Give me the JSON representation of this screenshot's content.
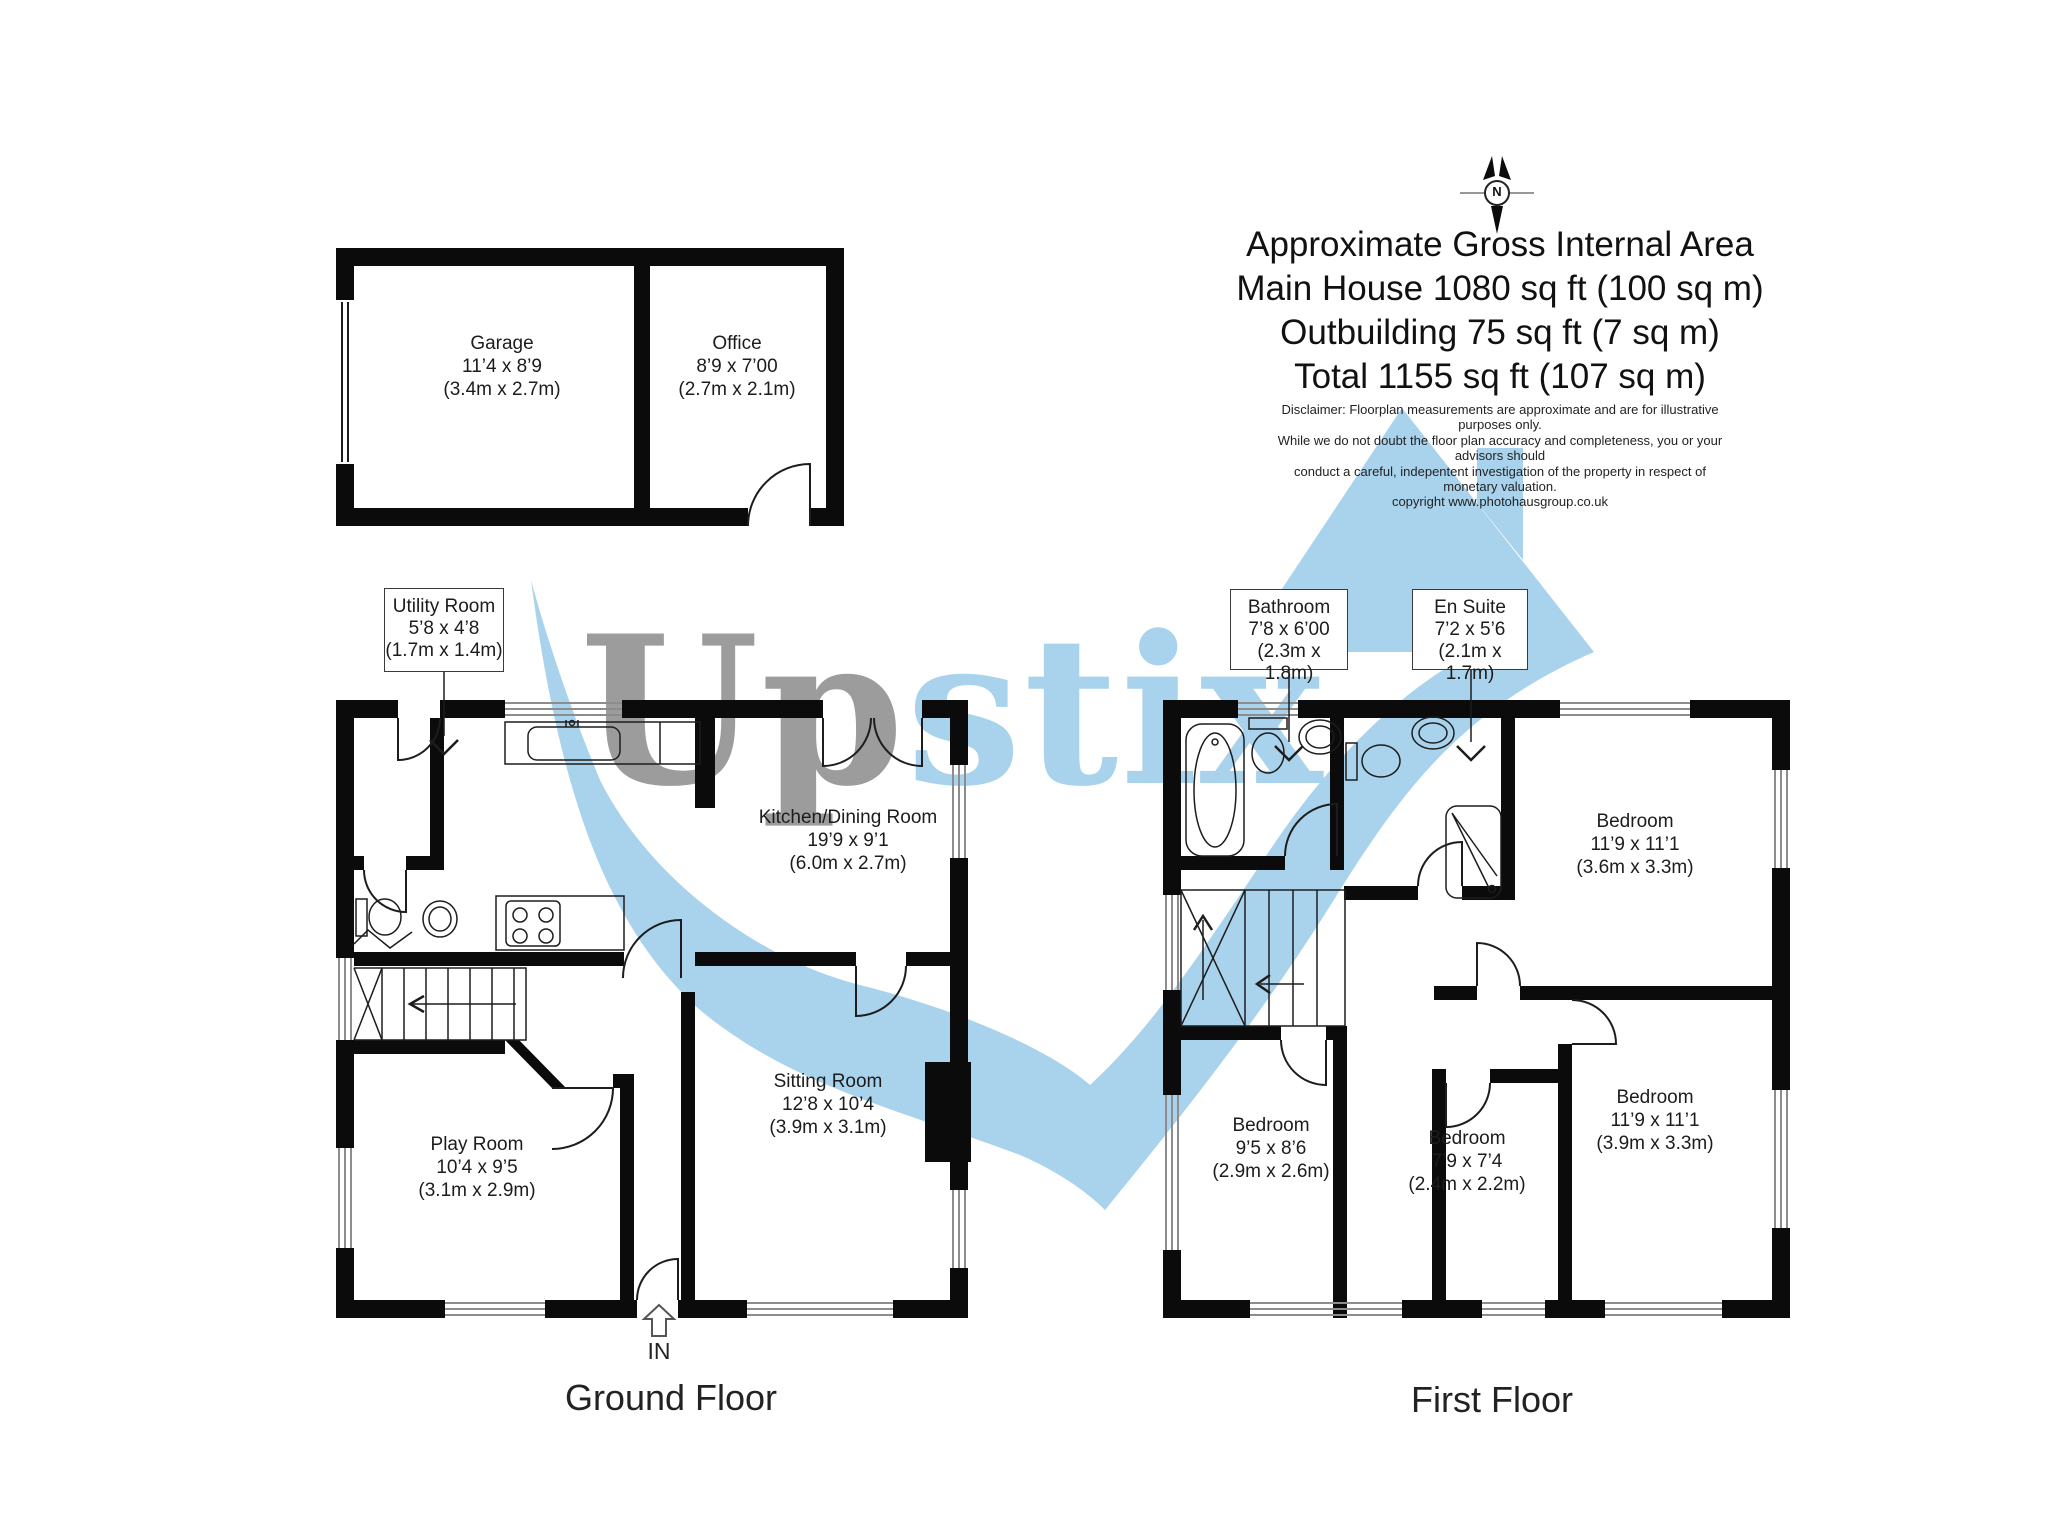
{
  "colors": {
    "wall": "#0b0b0b",
    "watermark_blue": "#a9d3ec",
    "watermark_gray": "#9c9c9c",
    "line": "#1d1d1d"
  },
  "watermark": {
    "part1": "Up",
    "part2": "stix"
  },
  "north": {
    "label": "N"
  },
  "title": {
    "line1": "Approximate Gross Internal Area",
    "line2": "Main House 1080 sq ft (100 sq m)",
    "line3": "Outbuilding 75 sq ft (7 sq m)",
    "line4": "Total 1155 sq ft (107 sq m)"
  },
  "disclaimer": {
    "line1": "Disclaimer: Floorplan measurements are approximate and are for illustrative purposes only.",
    "line2": "While we do not doubt the floor plan accuracy and completeness, you or your advisors should",
    "line3": "conduct a careful, indepentent investigation of the property in respect of monetary valuation.",
    "line4": "copyright www.photohausgroup.co.uk"
  },
  "captions": {
    "ground": "Ground Floor",
    "first": "First Floor"
  },
  "entrance": {
    "label": "IN"
  },
  "rooms": {
    "garage": {
      "name": "Garage",
      "imperial": "11’4 x 8’9",
      "metric": "(3.4m x 2.7m)"
    },
    "office": {
      "name": "Office",
      "imperial": "8’9 x 7’00",
      "metric": "(2.7m x 2.1m)"
    },
    "utility": {
      "name": "Utility Room",
      "imperial": "5’8 x 4’8",
      "metric": "(1.7m x 1.4m)"
    },
    "kitchen": {
      "name": "Kitchen/Dining Room",
      "imperial": "19’9 x 9’1",
      "metric": "(6.0m x 2.7m)"
    },
    "sitting": {
      "name": "Sitting Room",
      "imperial": "12’8 x 10’4",
      "metric": "(3.9m x 3.1m)"
    },
    "play": {
      "name": "Play Room",
      "imperial": "10’4 x 9’5",
      "metric": "(3.1m x 2.9m)"
    },
    "bathroom": {
      "name": "Bathroom",
      "imperial": "7’8 x 6’00",
      "metric": "(2.3m x 1.8m)"
    },
    "ensuite": {
      "name": "En Suite",
      "imperial": "7’2 x 5’6",
      "metric": "(2.1m x 1.7m)"
    },
    "bedroom1": {
      "name": "Bedroom",
      "imperial": "11’9 x 11’1",
      "metric": "(3.6m x 3.3m)"
    },
    "bedroom2": {
      "name": "Bedroom",
      "imperial": "11’9 x 11’1",
      "metric": "(3.9m x 3.3m)"
    },
    "bedroom3": {
      "name": "Bedroom",
      "imperial": "9’5 x 8’6",
      "metric": "(2.9m x 2.6m)"
    },
    "bedroom4": {
      "name": "Bedroom",
      "imperial": "7’9 x 7’4",
      "metric": "(2.4m x 2.2m)"
    }
  }
}
